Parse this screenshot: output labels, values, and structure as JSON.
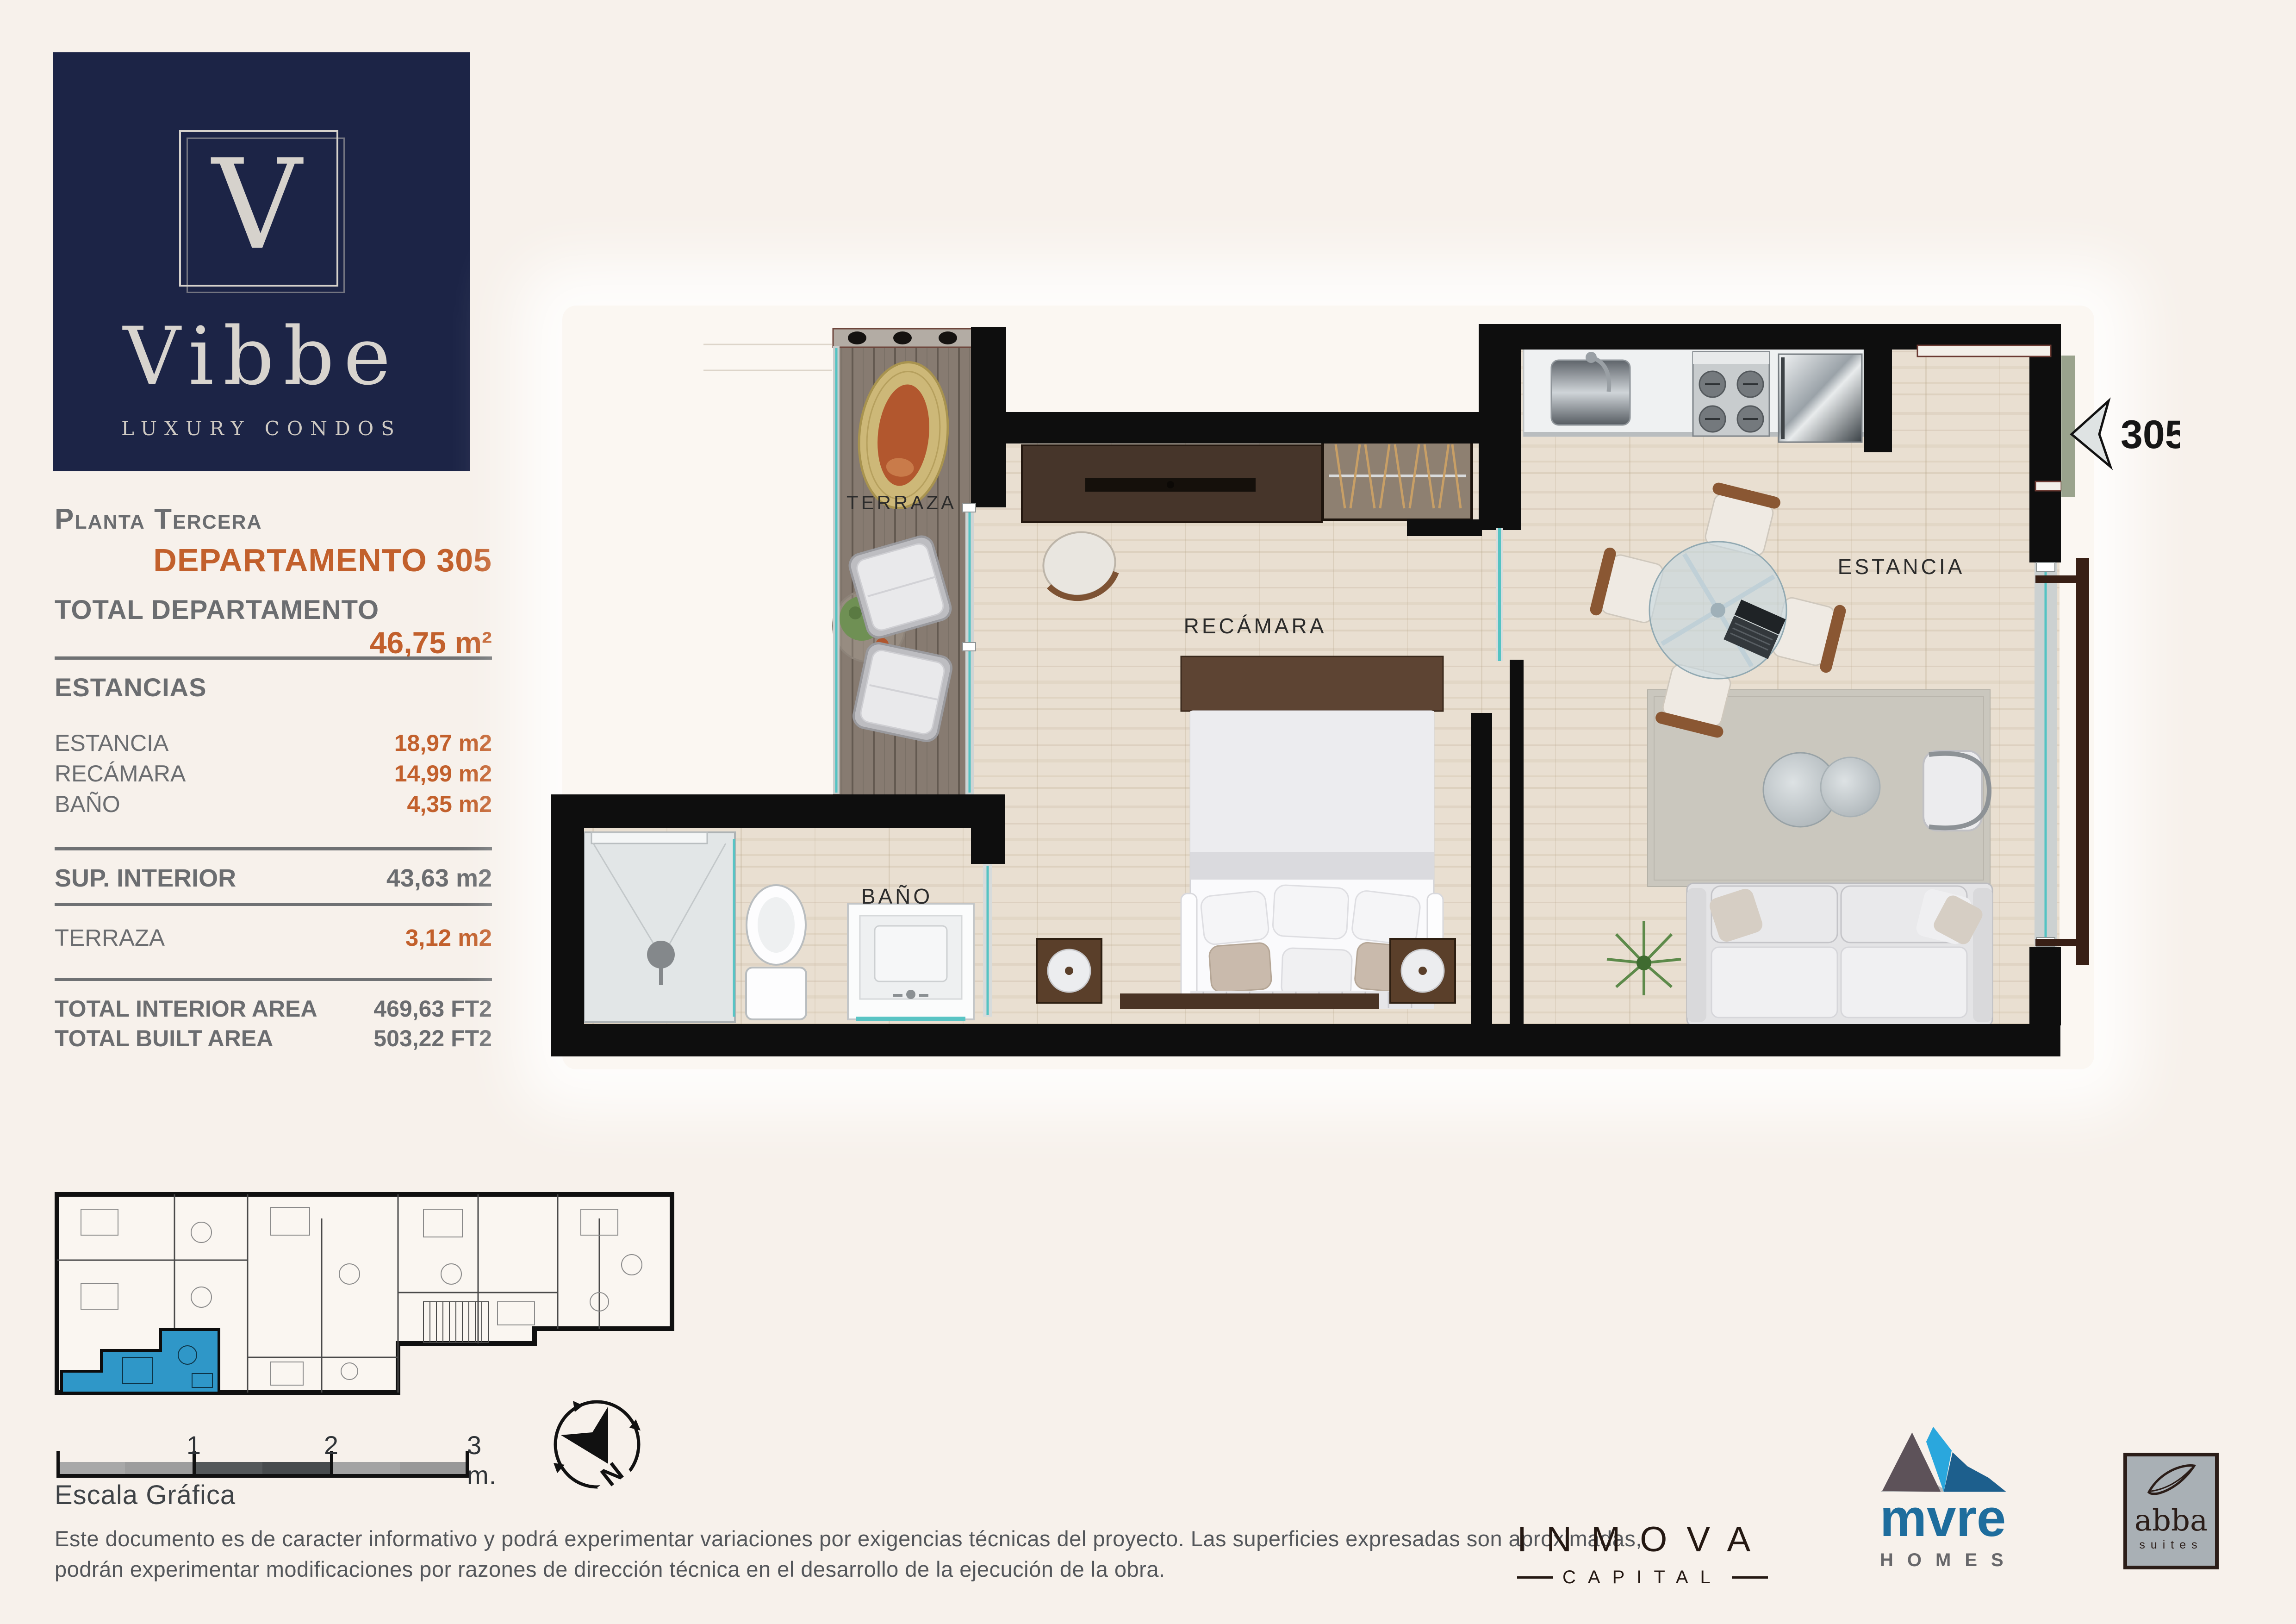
{
  "brand": {
    "initial": "V",
    "name": "Vibbe",
    "tagline": "LUXURY CONDOS"
  },
  "sidebar": {
    "floor": "Planta Tercera",
    "unit": "DEPARTAMENTO 305",
    "total_label": "TOTAL DEPARTAMENTO",
    "total_value": "46,75 m²",
    "sections_title": "ESTANCIAS",
    "rooms": [
      {
        "label": "ESTANCIA",
        "value": "18,97 m2"
      },
      {
        "label": "RECÁMARA",
        "value": "14,99 m2"
      },
      {
        "label": "BAÑO",
        "value": "4,35 m2"
      }
    ],
    "interior_label": "SUP. INTERIOR",
    "interior_value": "43,63 m2",
    "terrace_label": "TERRAZA",
    "terrace_value": "3,12 m2",
    "totals": [
      {
        "label": "TOTAL INTERIOR AREA",
        "value": "469,63 FT2"
      },
      {
        "label": "TOTAL BUILT AREA",
        "value": "503,22 FT2"
      }
    ]
  },
  "plan": {
    "unit_number": "305",
    "labels": {
      "terraza": "TERRAZA",
      "recamara": "RECÁMARA",
      "bano": "BAÑO",
      "estancia": "ESTANCIA"
    }
  },
  "scalebar": {
    "title": "Escala Gráfica",
    "tick1": "1",
    "tick2": "2",
    "tick3": "3 m."
  },
  "compass": {
    "north": "N"
  },
  "disclaimer": {
    "line1": "Este documento es de caracter informativo y podrá experimentar variaciones por exigencias técnicas del proyecto. Las superficies expresadas son aproximadas,",
    "line2": "podrán experimentar modificaciones por razones de dirección técnica en el desarrollo de la ejecución de la obra."
  },
  "partners": {
    "inmova": {
      "name": "INMOVA",
      "sub": "CAPITAL"
    },
    "mvre": {
      "name": "mvre",
      "sub": "HOMES"
    },
    "abba": {
      "name": "abba",
      "sub": "suites"
    }
  },
  "colors": {
    "accent_orange": "#c2602c",
    "text_gray": "#6b6d70",
    "brand_navy": "#1c2446",
    "glass_teal": "#54c3c3",
    "highlight_blue": "#2f97c8",
    "wall_black": "#0e0e0e"
  }
}
